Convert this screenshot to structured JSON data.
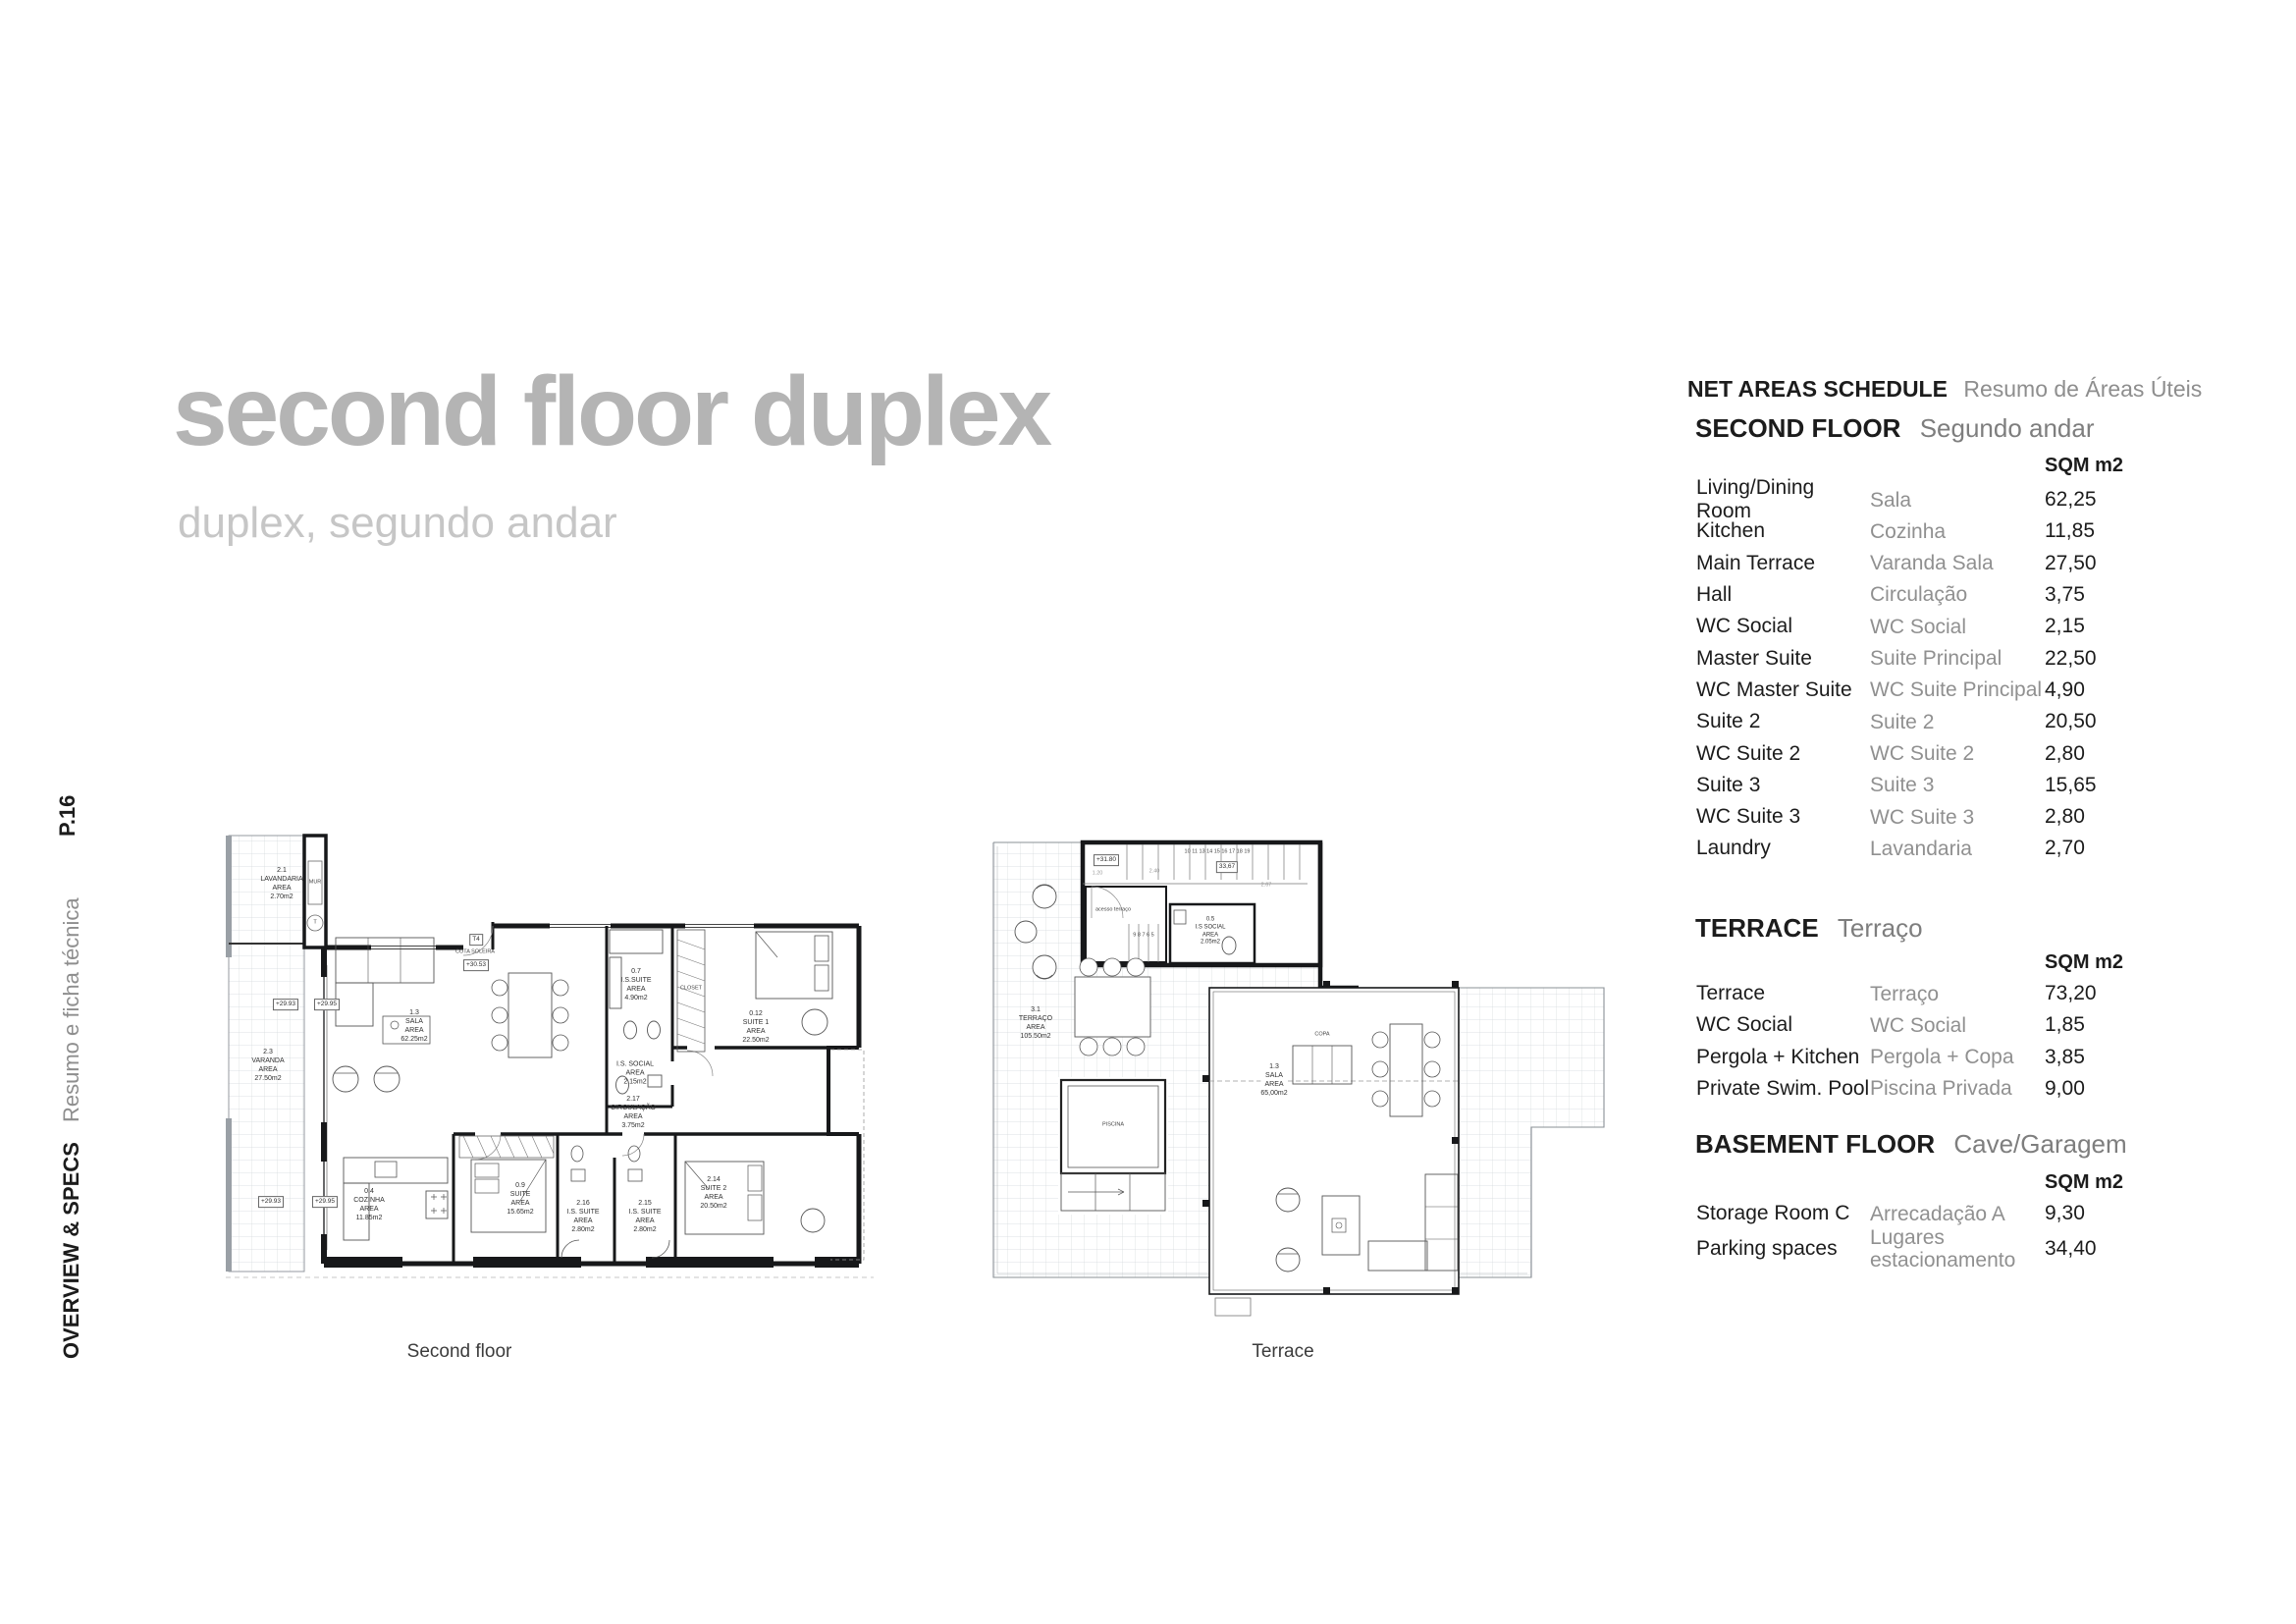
{
  "page": {
    "title": "second floor duplex",
    "subtitle": "duplex, segundo andar",
    "page_number": "P.16",
    "sidebar_en": "OVERVIEW & SPECS",
    "sidebar_pt": "Resumo e ficha técnica"
  },
  "schedule": {
    "header": {
      "en": "NET AREAS SCHEDULE",
      "pt": "Resumo de Áreas Úteis"
    },
    "sections": [
      {
        "heading_en": "SECOND FLOOR",
        "heading_pt": "Segundo andar",
        "unit": "SQM m2",
        "rows": [
          {
            "en": "Living/Dining Room",
            "pt": "Sala",
            "sqm": "62,25"
          },
          {
            "en": "Kitchen",
            "pt": "Cozinha",
            "sqm": "11,85"
          },
          {
            "en": "Main Terrace",
            "pt": "Varanda Sala",
            "sqm": "27,50"
          },
          {
            "en": "Hall",
            "pt": "Circulação",
            "sqm": "3,75"
          },
          {
            "en": "WC Social",
            "pt": "WC Social",
            "sqm": "2,15"
          },
          {
            "en": "Master Suite",
            "pt": "Suite Principal",
            "sqm": "22,50"
          },
          {
            "en": "WC Master Suite",
            "pt": "WC Suite Principal",
            "sqm": "4,90"
          },
          {
            "en": "Suite 2",
            "pt": "Suite 2",
            "sqm": "20,50"
          },
          {
            "en": "WC Suite 2",
            "pt": "WC Suite 2",
            "sqm": "2,80"
          },
          {
            "en": "Suite 3",
            "pt": "Suite 3",
            "sqm": "15,65"
          },
          {
            "en": "WC Suite 3",
            "pt": "WC Suite 3",
            "sqm": "2,80"
          },
          {
            "en": "Laundry",
            "pt": "Lavandaria",
            "sqm": "2,70"
          }
        ]
      },
      {
        "heading_en": "TERRACE",
        "heading_pt": "Terraço",
        "unit": "SQM m2",
        "rows": [
          {
            "en": "Terrace",
            "pt": "Terraço",
            "sqm": "73,20"
          },
          {
            "en": "WC Social",
            "pt": "WC Social",
            "sqm": "1,85"
          },
          {
            "en": "Pergola + Kitchen",
            "pt": "Pergola + Copa",
            "sqm": "3,85"
          },
          {
            "en": "Private Swim. Pool",
            "pt": "Piscina Privada",
            "sqm": "9,00"
          }
        ]
      },
      {
        "heading_en": "BASEMENT FLOOR",
        "heading_pt": "Cave/Garagem",
        "unit": "SQM m2",
        "rows": [
          {
            "en": "Storage Room C",
            "pt": "Arrecadação A",
            "sqm": "9,30"
          },
          {
            "en": "Parking spaces",
            "pt": "Lugares\nestacionamento",
            "sqm": "34,40"
          }
        ]
      }
    ]
  },
  "plans": {
    "second_floor": {
      "caption": "Second floor",
      "labels": [
        {
          "text": "2.1\nLAVANDARIA\nAREA\n2.70m2"
        },
        {
          "text": "MUR"
        },
        {
          "text": "T"
        },
        {
          "text": "T4"
        },
        {
          "text": "COTA SOLEIRA"
        },
        {
          "text": "+30.53"
        },
        {
          "text": "+29.93"
        },
        {
          "text": "+29.95"
        },
        {
          "text": "1.3\nSALA\nAREA\n62.25m2"
        },
        {
          "text": "0.7\nI.S.SUITE\nAREA\n4.90m2"
        },
        {
          "text": "CLOSET"
        },
        {
          "text": "0.12\nSUITE 1\nAREA\n22.50m2"
        },
        {
          "text": "I.S. SOCIAL\nAREA\n2.15m2"
        },
        {
          "text": "2.17\nCIRCULAÇÃO\nAREA\n3.75m2"
        },
        {
          "text": "2.3\nVARANDA\nAREA\n27.50m2"
        },
        {
          "text": "+29.93"
        },
        {
          "text": "+29.95"
        },
        {
          "text": "0.4\nCOZINHA\nAREA\n11.85m2"
        },
        {
          "text": "0.9\nSUITE\nAREA\n15.65m2"
        },
        {
          "text": "2.16\nI.S. SUITE\nAREA\n2.80m2"
        },
        {
          "text": "2.15\nI.S. SUITE\nAREA\n2.80m2"
        },
        {
          "text": "2.14\nSUITE 2\nAREA\n20.50m2"
        }
      ]
    },
    "terrace": {
      "caption": "Terrace",
      "labels": [
        {
          "text": "+31.80"
        },
        {
          "text": "10  11  13  14  15  16  17  18  19"
        },
        {
          "text": "33,67"
        },
        {
          "text": "1.20"
        },
        {
          "text": "2.40"
        },
        {
          "text": "2.67"
        },
        {
          "text": "acesso  terraço"
        },
        {
          "text": "9  8  7  6  5"
        },
        {
          "text": "0.5\nI.S SOCIAL\nAREA\n2.05m2"
        },
        {
          "text": "COPA"
        },
        {
          "text": "1.3\nSALA\nAREA\n65,00m2"
        },
        {
          "text": "3.1\nTERRAÇO\nAREA\n105.50m2"
        },
        {
          "text": "PISCINA"
        }
      ]
    }
  }
}
